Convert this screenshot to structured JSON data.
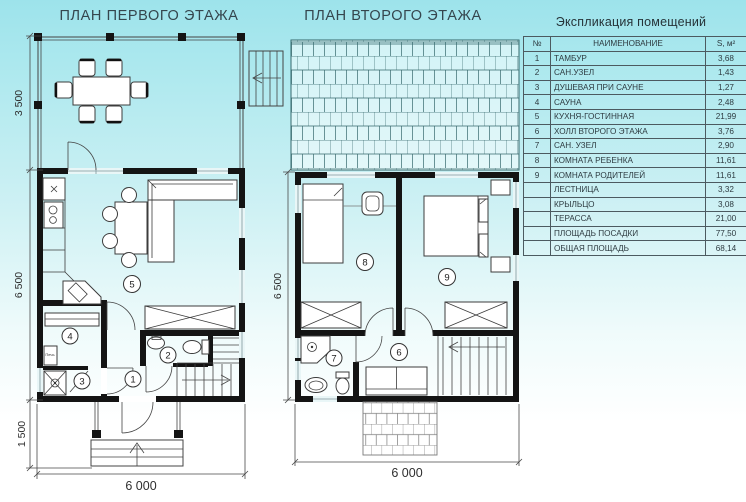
{
  "titles": {
    "plan1": "ПЛАН ПЕРВОГО ЭТАЖА",
    "plan2": "ПЛАН ВТОРОГО ЭТАЖА"
  },
  "plan1": {
    "dims": {
      "terrace_height": "3 500",
      "main_height": "6 500",
      "porch_height": "1 500",
      "width": "6 000"
    },
    "room_numbers": {
      "r1": "1",
      "r2": "2",
      "r3": "3",
      "r4": "4",
      "r5": "5"
    },
    "labels": {
      "stove": "Печь"
    }
  },
  "plan2": {
    "dims": {
      "main_height": "6 500",
      "width": "6 000"
    },
    "room_numbers": {
      "r6": "6",
      "r7": "7",
      "r8": "8",
      "r9": "9"
    }
  },
  "legend": {
    "title": "Экспликация помещений",
    "columns": {
      "num": "№",
      "name": "НАИМЕНОВАНИЕ",
      "area": "S, м²"
    },
    "rows": [
      {
        "num": "1",
        "name": "ТАМБУР",
        "area": "3,68"
      },
      {
        "num": "2",
        "name": "САН.УЗЕЛ",
        "area": "1,43"
      },
      {
        "num": "3",
        "name": "ДУШЕВАЯ ПРИ САУНЕ",
        "area": "1,27"
      },
      {
        "num": "4",
        "name": "САУНА",
        "area": "2,48"
      },
      {
        "num": "5",
        "name": "КУХНЯ-ГОСТИННАЯ",
        "area": "21,99"
      },
      {
        "num": "6",
        "name": "ХОЛЛ ВТОРОГО ЭТАЖА",
        "area": "3,76"
      },
      {
        "num": "7",
        "name": "САН. УЗЕЛ",
        "area": "2,90"
      },
      {
        "num": "8",
        "name": "КОМНАТА РЕБЕНКА",
        "area": "11,61"
      },
      {
        "num": "9",
        "name": "КОМНАТА РОДИТЕЛЕЙ",
        "area": "11,61"
      },
      {
        "num": "",
        "name": "ЛЕСТНИЦА",
        "area": "3,32"
      },
      {
        "num": "",
        "name": "КРЫЛЬЦО",
        "area": "3,08"
      },
      {
        "num": "",
        "name": "ТЕРАССА",
        "area": "21,00"
      },
      {
        "num": "",
        "name": "ПЛОЩАДЬ ПОСАДКИ",
        "area": "77,50"
      },
      {
        "num": "",
        "name": "ОБЩАЯ ПЛОЩАДЬ",
        "area": "68,14"
      }
    ]
  },
  "colors": {
    "background_top": "#9de3eb",
    "background_bottom": "#ffffff",
    "wall": "#141414",
    "roof_line": "#35686c"
  }
}
